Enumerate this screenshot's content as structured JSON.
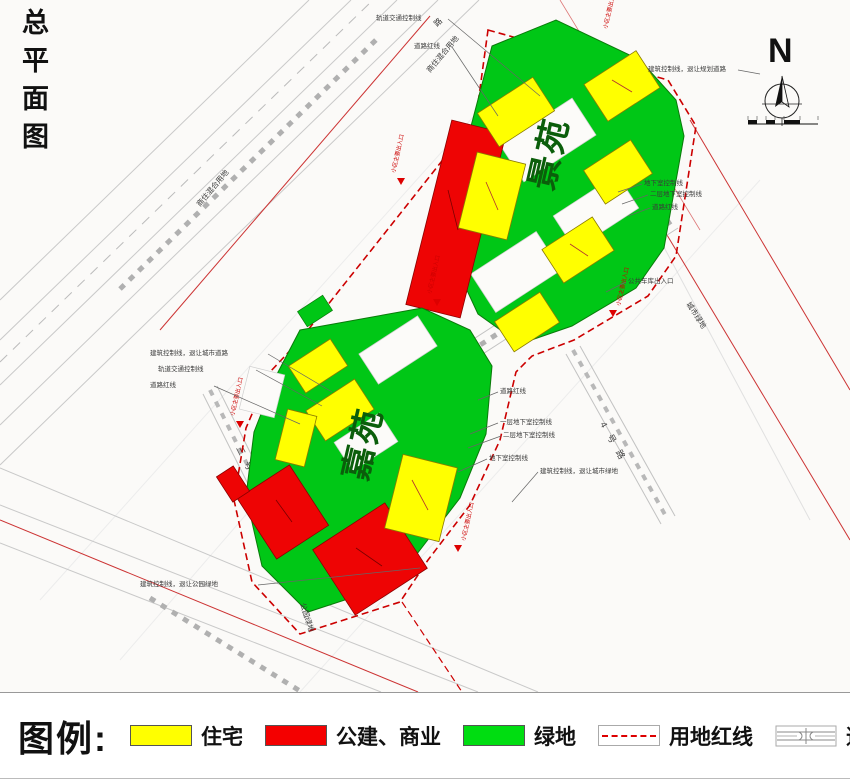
{
  "title": {
    "text": "总平面图"
  },
  "north": {
    "label": "N"
  },
  "areas": {
    "upper": "景苑",
    "lower": "嘉苑"
  },
  "legend": {
    "heading": "图例:",
    "items": [
      {
        "label": "住宅",
        "color": "#ffff00",
        "type": "swatch"
      },
      {
        "label": "公建、商业",
        "color": "#f40000",
        "type": "swatch"
      },
      {
        "label": "绿地",
        "color": "#00dd11",
        "type": "swatch"
      },
      {
        "label": "用地红线",
        "color": "#dd0000",
        "type": "dashed-line"
      },
      {
        "label": "道路红线",
        "color": "#999999",
        "type": "road-symbol"
      }
    ]
  },
  "labels": {
    "rail_control": "轨道交通控制线",
    "road_redline": "道路红线",
    "mixed_use": "商住混合用地",
    "park_green": "公园绿地",
    "city_green": "城市绿地",
    "setback_road": "建筑控制线，退让城市道路",
    "setback_park": "建筑控制线，退让公园绿地",
    "setback_plan_road": "建筑控制线，退让规划道路",
    "setback_city_green": "建筑控制线，退让城市绿地",
    "basement_l1": "一层地下室控制线",
    "basement_l2": "二层地下室控制线",
    "basement": "地下室控制线",
    "entrance": "小区主要出入口",
    "garage_entrance": "公共车库出入口",
    "road_3": "三号路",
    "road_4": "4号路",
    "road_char": "路"
  },
  "colors": {
    "residential": "#ffff00",
    "commercial": "#ee0404",
    "green_space": "#00c716",
    "land_redline": "#cc0000",
    "road_line": "#b0b0b0",
    "area_label": "#0b5e0b"
  }
}
